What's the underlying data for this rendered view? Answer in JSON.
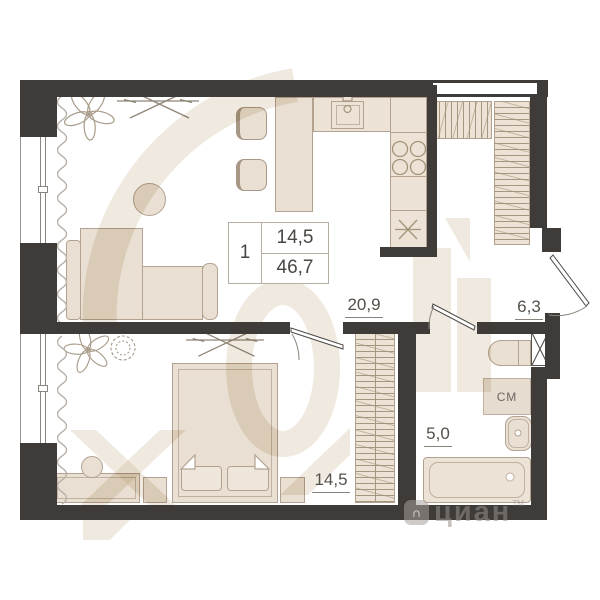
{
  "plan": {
    "type": "apartment-floor-plan",
    "rooms": {
      "living_kitchen": {
        "label": "20,9"
      },
      "hallway": {
        "label": "6,3"
      },
      "bathroom": {
        "label": "5,0"
      },
      "bedroom": {
        "label": "14,5"
      }
    },
    "info_box": {
      "rooms_count": "1",
      "living_area": "14,5",
      "total_area": "46,7"
    },
    "appliances": {
      "washing_machine": "СМ"
    }
  },
  "brand": {
    "logo_glyph": "∩",
    "name": "циан",
    "tm": "TM"
  },
  "colors": {
    "wall": "#3e3b39",
    "furniture_fill": "#e9dfd2",
    "furniture_outline": "#b3a290",
    "hatch_line": "#a5967f",
    "label_text": "#55504a",
    "watermark_beige": "#cbb69e",
    "brand_gray": "#968f89",
    "floor": "#ffffff"
  }
}
